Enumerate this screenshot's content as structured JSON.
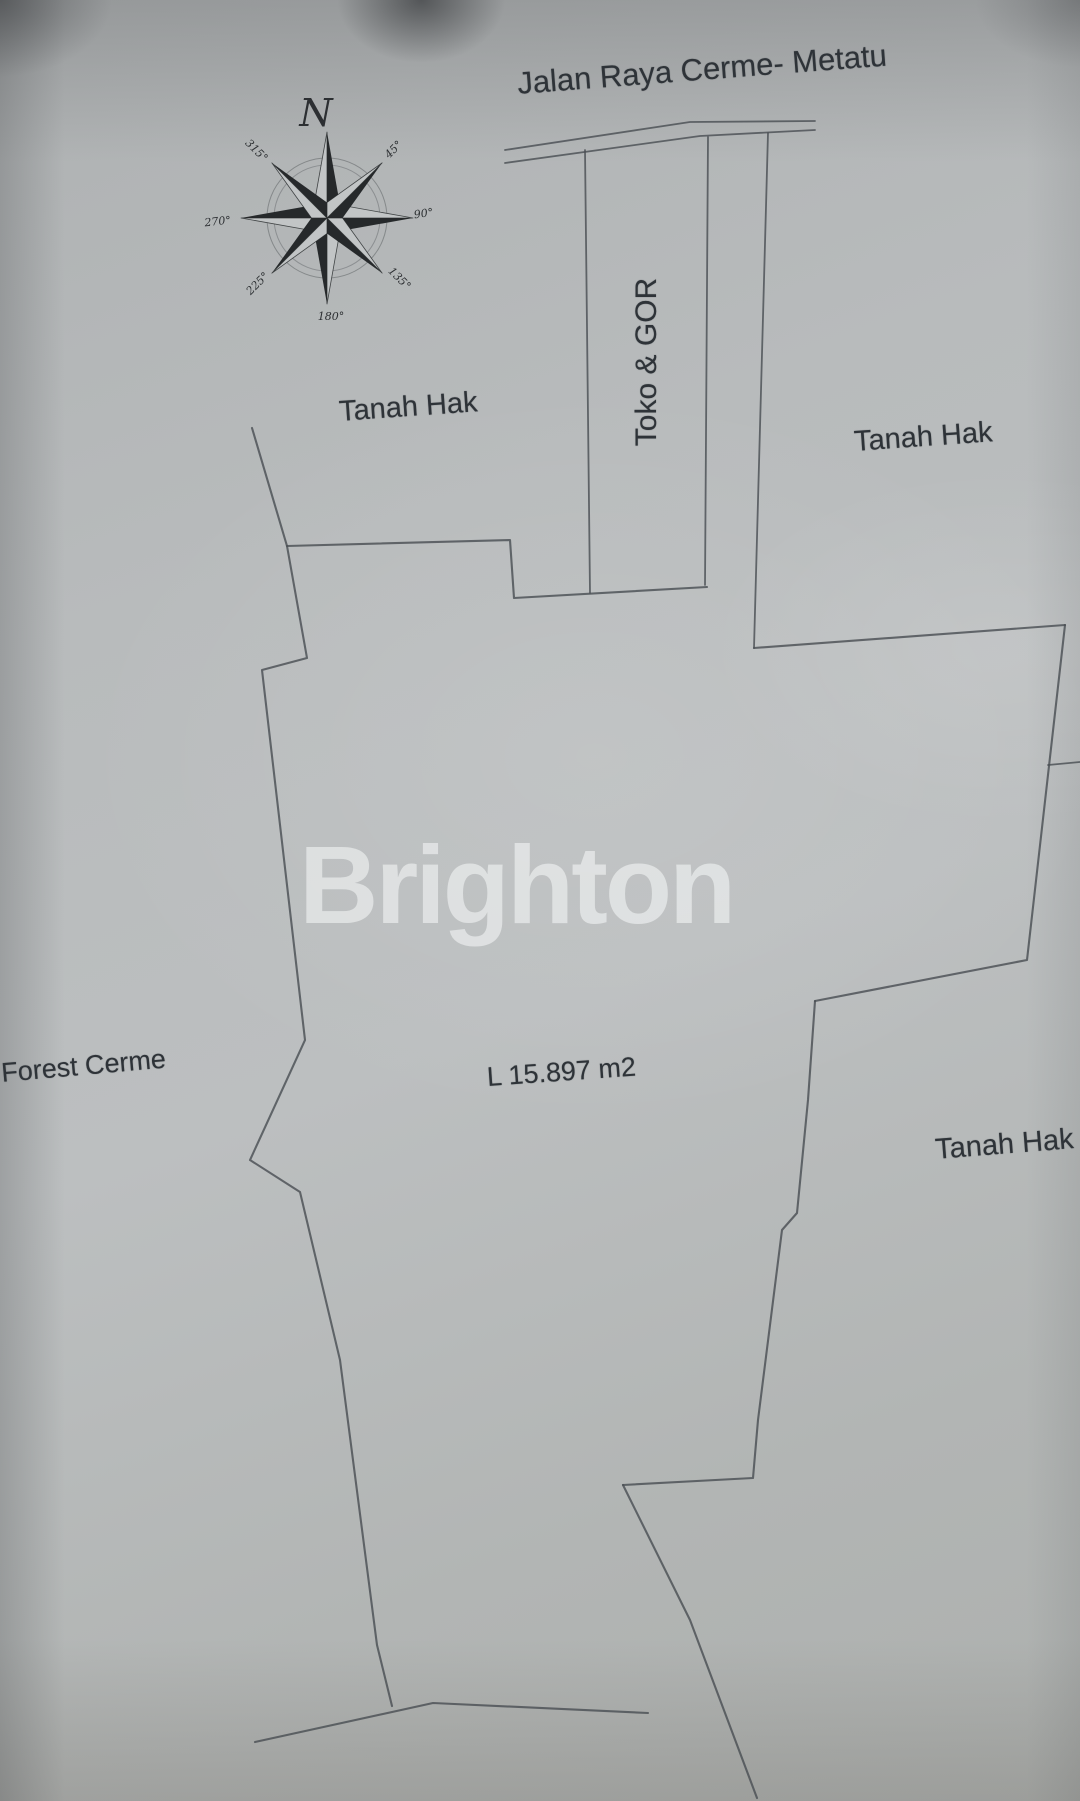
{
  "map": {
    "road_label": "Jalan Raya Cerme- Metatu",
    "area_label": "L 15.897 m2",
    "watermark": "Brighton",
    "labels": {
      "toko_gor": "Toko & GOR",
      "tanah_hak_left": "Tanah Hak",
      "tanah_hak_right_top": "Tanah Hak",
      "tanah_hak_right_bottom": "Tanah Hak",
      "forest_cerme": "Forest Cerme"
    },
    "compass": {
      "north": "N",
      "d45": "45°",
      "d90": "90°",
      "d135": "135°",
      "d180": "180°",
      "d225": "225°",
      "d270": "270°",
      "d315": "315°"
    },
    "colors": {
      "paper": "#b7babb",
      "line": "#4b4f54",
      "text": "#2e3338",
      "compass_dark": "#26292b",
      "watermark": "rgba(255,255,255,0.52)"
    }
  }
}
